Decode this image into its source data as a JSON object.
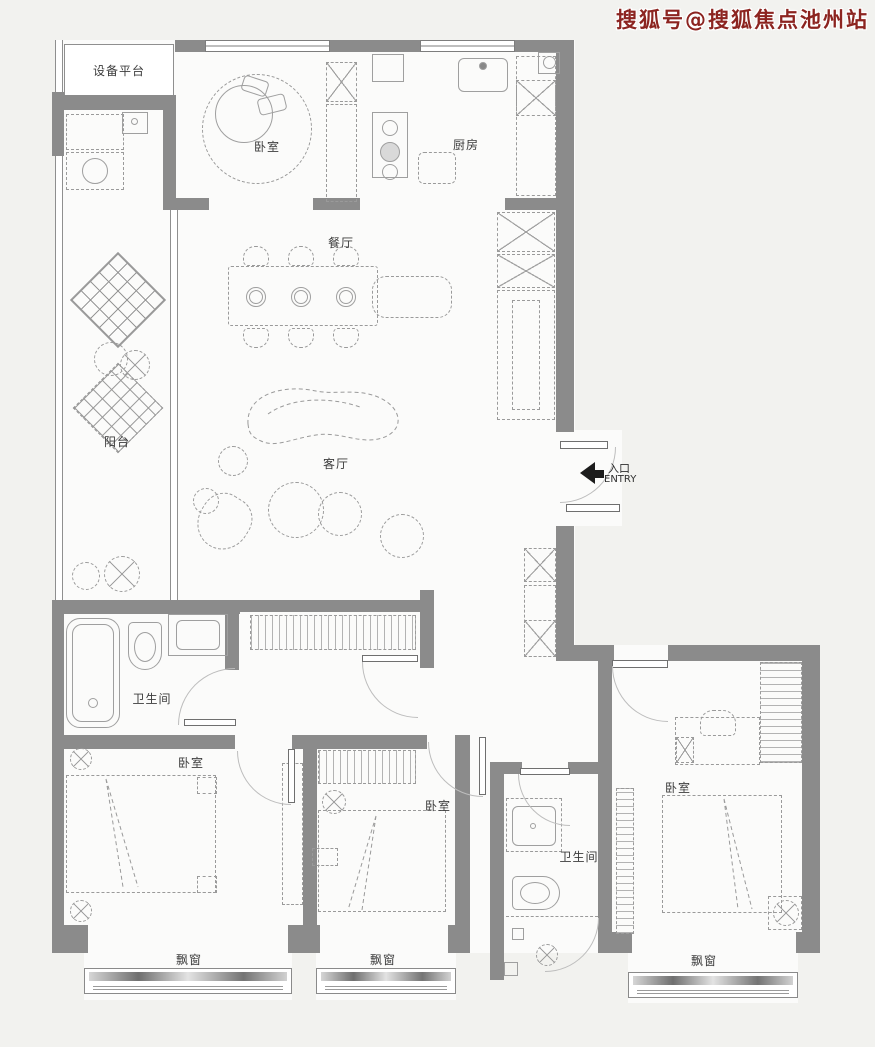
{
  "watermark": {
    "text": "搜狐号@搜狐焦点池州站"
  },
  "colors": {
    "wall": "#8b8b8b",
    "watermark_red": "#8c2420",
    "furniture_line": "#9a9a9a",
    "background": "#f2f2ef",
    "floor": "#fbfbfa",
    "entry_arrow": "#1c1c1c"
  },
  "labels": {
    "equipment_platform": "设备平台",
    "bedroom_top": "卧室",
    "kitchen": "厨房",
    "dining_room": "餐厅",
    "balcony": "阳台",
    "living_room": "客厅",
    "bathroom_main": "卫生间",
    "bedroom_left": "卧室",
    "bedroom_middle": "卧室",
    "bathroom_second": "卫生间",
    "bedroom_right": "卧室",
    "bay_window_left": "飘窗",
    "bay_window_middle": "飘窗",
    "bay_window_right": "飘窗",
    "entry_cn": "入口",
    "entry_en": "ENTRY"
  }
}
